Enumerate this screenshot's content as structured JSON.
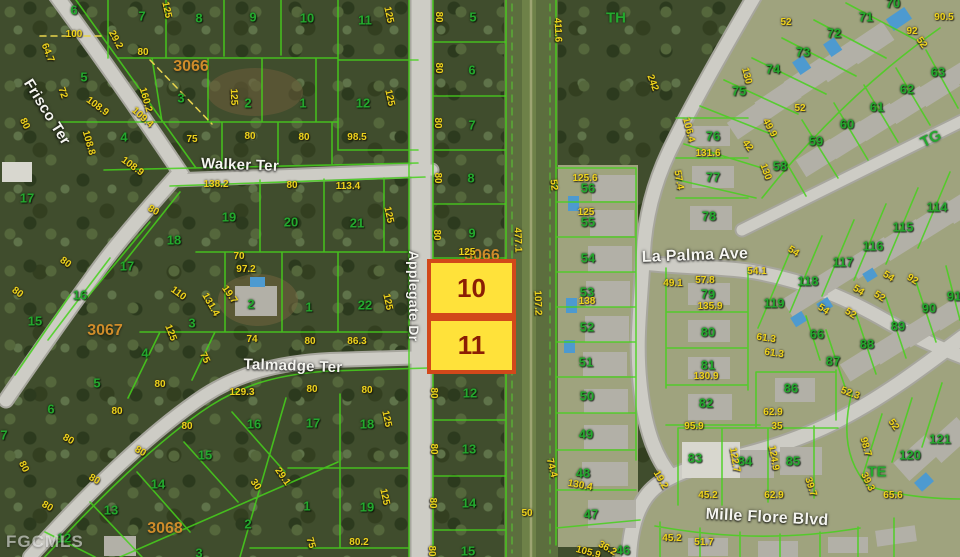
{
  "source_watermark": "FGCMLS",
  "colors": {
    "lot_text": "#24a82e",
    "dimension_text": "#eed31d",
    "block_text": "#cf8c2a",
    "street_text": "#f5f5f0",
    "parcel_line": "#47d11c",
    "highlight_fill": "#ffe23a",
    "highlight_border": "#d2481a",
    "highlight_text": "#8b1e04"
  },
  "highlight": {
    "lots": [
      {
        "label": "10"
      },
      {
        "label": "11"
      }
    ]
  },
  "map": {
    "street_labels": [
      {
        "t": "Frisco Ter",
        "x": 47,
        "y": 112,
        "r": 58,
        "s": 15
      },
      {
        "t": "Walker Ter",
        "x": 240,
        "y": 165,
        "r": 2,
        "s": 15
      },
      {
        "t": "Applegate Dr",
        "x": 414,
        "y": 296,
        "r": 90,
        "s": 14
      },
      {
        "t": "Talmadge Ter",
        "x": 293,
        "y": 366,
        "r": 2,
        "s": 15
      },
      {
        "t": "La Palma Ave",
        "x": 695,
        "y": 256,
        "r": -2,
        "s": 16
      },
      {
        "t": "Mille Flore Blvd",
        "x": 767,
        "y": 518,
        "r": 3,
        "s": 16
      }
    ],
    "block_labels": [
      {
        "t": "3066",
        "x": 191,
        "y": 67
      },
      {
        "t": "3066",
        "x": 482,
        "y": 256,
        "z": 3
      },
      {
        "t": "3067",
        "x": 105,
        "y": 331
      },
      {
        "t": "3068",
        "x": 165,
        "y": 529
      }
    ],
    "area_labels": [
      {
        "t": "TH",
        "x": 616,
        "y": 18
      },
      {
        "t": "TG",
        "x": 931,
        "y": 139,
        "r": -26
      },
      {
        "t": "TE",
        "x": 877,
        "y": 472
      }
    ],
    "lot_numbers": [
      {
        "t": "6",
        "x": 74,
        "y": 10
      },
      {
        "t": "7",
        "x": 142,
        "y": 16
      },
      {
        "t": "8",
        "x": 199,
        "y": 18
      },
      {
        "t": "9",
        "x": 253,
        "y": 17
      },
      {
        "t": "10",
        "x": 307,
        "y": 18
      },
      {
        "t": "11",
        "x": 365,
        "y": 20
      },
      {
        "t": "5",
        "x": 84,
        "y": 77
      },
      {
        "t": "3",
        "x": 181,
        "y": 98
      },
      {
        "t": "2",
        "x": 248,
        "y": 103
      },
      {
        "t": "1",
        "x": 303,
        "y": 103
      },
      {
        "t": "12",
        "x": 363,
        "y": 103
      },
      {
        "t": "4",
        "x": 124,
        "y": 137
      },
      {
        "t": "17",
        "x": 27,
        "y": 198
      },
      {
        "t": "5",
        "x": 473,
        "y": 17
      },
      {
        "t": "6",
        "x": 472,
        "y": 70
      },
      {
        "t": "7",
        "x": 472,
        "y": 125
      },
      {
        "t": "8",
        "x": 471,
        "y": 178
      },
      {
        "t": "9",
        "x": 472,
        "y": 233
      },
      {
        "t": "12",
        "x": 470,
        "y": 393
      },
      {
        "t": "13",
        "x": 469,
        "y": 449
      },
      {
        "t": "14",
        "x": 469,
        "y": 503
      },
      {
        "t": "15",
        "x": 468,
        "y": 551
      },
      {
        "t": "19",
        "x": 229,
        "y": 217
      },
      {
        "t": "20",
        "x": 291,
        "y": 222
      },
      {
        "t": "21",
        "x": 357,
        "y": 223
      },
      {
        "t": "18",
        "x": 174,
        "y": 240
      },
      {
        "t": "17",
        "x": 127,
        "y": 266
      },
      {
        "t": "16",
        "x": 80,
        "y": 295
      },
      {
        "t": "15",
        "x": 35,
        "y": 321
      },
      {
        "t": "2",
        "x": 251,
        "y": 304
      },
      {
        "t": "1",
        "x": 309,
        "y": 307
      },
      {
        "t": "22",
        "x": 365,
        "y": 305
      },
      {
        "t": "3",
        "x": 192,
        "y": 323
      },
      {
        "t": "4",
        "x": 145,
        "y": 353
      },
      {
        "t": "5",
        "x": 97,
        "y": 383
      },
      {
        "t": "6",
        "x": 51,
        "y": 409
      },
      {
        "t": "7",
        "x": 4,
        "y": 435
      },
      {
        "t": "17",
        "x": 313,
        "y": 423
      },
      {
        "t": "18",
        "x": 367,
        "y": 424
      },
      {
        "t": "16",
        "x": 254,
        "y": 424
      },
      {
        "t": "15",
        "x": 205,
        "y": 455
      },
      {
        "t": "14",
        "x": 158,
        "y": 484
      },
      {
        "t": "13",
        "x": 111,
        "y": 510
      },
      {
        "t": "12",
        "x": 64,
        "y": 538
      },
      {
        "t": "19",
        "x": 367,
        "y": 507
      },
      {
        "t": "1",
        "x": 307,
        "y": 506
      },
      {
        "t": "2",
        "x": 248,
        "y": 524
      },
      {
        "t": "3",
        "x": 199,
        "y": 553
      },
      {
        "t": "56",
        "x": 588,
        "y": 188
      },
      {
        "t": "55",
        "x": 588,
        "y": 222
      },
      {
        "t": "54",
        "x": 588,
        "y": 258
      },
      {
        "t": "53",
        "x": 587,
        "y": 292
      },
      {
        "t": "52",
        "x": 587,
        "y": 327
      },
      {
        "t": "51",
        "x": 586,
        "y": 362
      },
      {
        "t": "50",
        "x": 587,
        "y": 396
      },
      {
        "t": "49",
        "x": 586,
        "y": 434
      },
      {
        "t": "48",
        "x": 583,
        "y": 473
      },
      {
        "t": "47",
        "x": 591,
        "y": 514
      },
      {
        "t": "46",
        "x": 623,
        "y": 550
      },
      {
        "t": "70",
        "x": 893,
        "y": 3
      },
      {
        "t": "71",
        "x": 866,
        "y": 17
      },
      {
        "t": "72",
        "x": 834,
        "y": 33
      },
      {
        "t": "73",
        "x": 803,
        "y": 52
      },
      {
        "t": "74",
        "x": 773,
        "y": 69
      },
      {
        "t": "75",
        "x": 739,
        "y": 91
      },
      {
        "t": "76",
        "x": 713,
        "y": 136
      },
      {
        "t": "77",
        "x": 713,
        "y": 177
      },
      {
        "t": "78",
        "x": 709,
        "y": 216
      },
      {
        "t": "58",
        "x": 780,
        "y": 166
      },
      {
        "t": "59",
        "x": 816,
        "y": 141
      },
      {
        "t": "60",
        "x": 847,
        "y": 124
      },
      {
        "t": "61",
        "x": 877,
        "y": 107
      },
      {
        "t": "62",
        "x": 907,
        "y": 89
      },
      {
        "t": "63",
        "x": 938,
        "y": 72
      },
      {
        "t": "114",
        "x": 937,
        "y": 207
      },
      {
        "t": "115",
        "x": 903,
        "y": 227
      },
      {
        "t": "116",
        "x": 873,
        "y": 246
      },
      {
        "t": "117",
        "x": 843,
        "y": 262
      },
      {
        "t": "118",
        "x": 808,
        "y": 281
      },
      {
        "t": "119",
        "x": 774,
        "y": 303
      },
      {
        "t": "79",
        "x": 708,
        "y": 294
      },
      {
        "t": "80",
        "x": 708,
        "y": 332
      },
      {
        "t": "81",
        "x": 708,
        "y": 365
      },
      {
        "t": "66",
        "x": 817,
        "y": 334
      },
      {
        "t": "87",
        "x": 833,
        "y": 361
      },
      {
        "t": "88",
        "x": 867,
        "y": 344
      },
      {
        "t": "89",
        "x": 898,
        "y": 326
      },
      {
        "t": "90",
        "x": 929,
        "y": 308
      },
      {
        "t": "91",
        "x": 954,
        "y": 296
      },
      {
        "t": "86",
        "x": 791,
        "y": 388
      },
      {
        "t": "82",
        "x": 706,
        "y": 403
      },
      {
        "t": "83",
        "x": 695,
        "y": 458
      },
      {
        "t": "84",
        "x": 745,
        "y": 461
      },
      {
        "t": "85",
        "x": 793,
        "y": 461
      },
      {
        "t": "120",
        "x": 910,
        "y": 455
      },
      {
        "t": "121",
        "x": 940,
        "y": 439
      }
    ],
    "dimension_labels": [
      {
        "t": "100",
        "x": 74,
        "y": 35
      },
      {
        "t": "29.2",
        "x": 115,
        "y": 40,
        "r": 62
      },
      {
        "t": "80",
        "x": 143,
        "y": 53
      },
      {
        "t": "125",
        "x": 166,
        "y": 10,
        "r": 78
      },
      {
        "t": "64.7",
        "x": 47,
        "y": 53,
        "r": 68
      },
      {
        "t": "72",
        "x": 62,
        "y": 93,
        "r": 72
      },
      {
        "t": "108.9",
        "x": 97,
        "y": 107,
        "r": 36
      },
      {
        "t": "160.2",
        "x": 145,
        "y": 100,
        "r": 74
      },
      {
        "t": "109.4",
        "x": 142,
        "y": 118,
        "r": 42
      },
      {
        "t": "108.8",
        "x": 88,
        "y": 143,
        "r": 74
      },
      {
        "t": "108.9",
        "x": 132,
        "y": 167,
        "r": 36
      },
      {
        "t": "125",
        "x": 233,
        "y": 97,
        "r": 88
      },
      {
        "t": "75",
        "x": 192,
        "y": 140
      },
      {
        "t": "80",
        "x": 250,
        "y": 137
      },
      {
        "t": "80",
        "x": 304,
        "y": 138
      },
      {
        "t": "80",
        "x": 24,
        "y": 124,
        "r": 64
      },
      {
        "t": "138.2",
        "x": 216,
        "y": 185
      },
      {
        "t": "80",
        "x": 292,
        "y": 186
      },
      {
        "t": "113.4",
        "x": 348,
        "y": 187
      },
      {
        "t": "98.5",
        "x": 357,
        "y": 138
      },
      {
        "t": "125",
        "x": 388,
        "y": 15,
        "r": 78
      },
      {
        "t": "125",
        "x": 389,
        "y": 98,
        "r": 78
      },
      {
        "t": "80",
        "x": 438,
        "y": 17,
        "r": 90
      },
      {
        "t": "80",
        "x": 438,
        "y": 68,
        "r": 90
      },
      {
        "t": "80",
        "x": 437,
        "y": 123,
        "r": 90
      },
      {
        "t": "80",
        "x": 437,
        "y": 178,
        "r": 90
      },
      {
        "t": "80",
        "x": 436,
        "y": 235,
        "r": 90
      },
      {
        "t": "125",
        "x": 467,
        "y": 253
      },
      {
        "t": "477.1",
        "x": 517,
        "y": 240,
        "r": 88
      },
      {
        "t": "107.2",
        "x": 537,
        "y": 303,
        "r": 88
      },
      {
        "t": "411.6",
        "x": 557,
        "y": 30,
        "r": 88
      },
      {
        "t": "80",
        "x": 433,
        "y": 393,
        "r": 90
      },
      {
        "t": "80",
        "x": 433,
        "y": 449,
        "r": 90
      },
      {
        "t": "80",
        "x": 432,
        "y": 503,
        "r": 90
      },
      {
        "t": "80",
        "x": 431,
        "y": 551,
        "r": 90
      },
      {
        "t": "50",
        "x": 527,
        "y": 514
      },
      {
        "t": "125",
        "x": 388,
        "y": 215,
        "r": 78
      },
      {
        "t": "125",
        "x": 387,
        "y": 302,
        "r": 78
      },
      {
        "t": "70",
        "x": 239,
        "y": 257
      },
      {
        "t": "97.2",
        "x": 246,
        "y": 270
      },
      {
        "t": "19.7",
        "x": 229,
        "y": 295,
        "r": 55
      },
      {
        "t": "110",
        "x": 178,
        "y": 294,
        "r": 36
      },
      {
        "t": "131.4",
        "x": 210,
        "y": 305,
        "r": 60
      },
      {
        "t": "86.3",
        "x": 357,
        "y": 342
      },
      {
        "t": "80",
        "x": 310,
        "y": 342
      },
      {
        "t": "74",
        "x": 252,
        "y": 340
      },
      {
        "t": "125",
        "x": 170,
        "y": 333,
        "r": 68
      },
      {
        "t": "75",
        "x": 204,
        "y": 358,
        "r": 64
      },
      {
        "t": "80",
        "x": 153,
        "y": 211,
        "r": 30
      },
      {
        "t": "80",
        "x": 65,
        "y": 263,
        "r": 36
      },
      {
        "t": "80",
        "x": 17,
        "y": 293,
        "r": 36
      },
      {
        "t": "129.3",
        "x": 242,
        "y": 393
      },
      {
        "t": "80",
        "x": 160,
        "y": 385
      },
      {
        "t": "80",
        "x": 117,
        "y": 412
      },
      {
        "t": "80",
        "x": 68,
        "y": 440,
        "r": 30
      },
      {
        "t": "80",
        "x": 23,
        "y": 467,
        "r": 64
      },
      {
        "t": "80",
        "x": 47,
        "y": 507,
        "r": 30
      },
      {
        "t": "80",
        "x": 187,
        "y": 427
      },
      {
        "t": "80",
        "x": 140,
        "y": 452,
        "r": 30
      },
      {
        "t": "80",
        "x": 94,
        "y": 480,
        "r": 30
      },
      {
        "t": "29.1",
        "x": 282,
        "y": 477,
        "r": 55
      },
      {
        "t": "30",
        "x": 255,
        "y": 485,
        "r": 55
      },
      {
        "t": "75",
        "x": 310,
        "y": 543,
        "r": 74
      },
      {
        "t": "80.2",
        "x": 359,
        "y": 543
      },
      {
        "t": "125",
        "x": 386,
        "y": 419,
        "r": 78
      },
      {
        "t": "125",
        "x": 384,
        "y": 497,
        "r": 78
      },
      {
        "t": "80",
        "x": 312,
        "y": 390
      },
      {
        "t": "80",
        "x": 367,
        "y": 391
      },
      {
        "t": "242",
        "x": 652,
        "y": 83,
        "r": 70
      },
      {
        "t": "106.4",
        "x": 688,
        "y": 130,
        "r": 76
      },
      {
        "t": "52",
        "x": 786,
        "y": 23
      },
      {
        "t": "90.5",
        "x": 944,
        "y": 18
      },
      {
        "t": "92",
        "x": 912,
        "y": 32
      },
      {
        "t": "52",
        "x": 921,
        "y": 43,
        "r": 55
      },
      {
        "t": "52",
        "x": 800,
        "y": 109
      },
      {
        "t": "49.9",
        "x": 769,
        "y": 128,
        "r": 62
      },
      {
        "t": "42",
        "x": 747,
        "y": 146,
        "r": 55
      },
      {
        "t": "131.6",
        "x": 708,
        "y": 154
      },
      {
        "t": "130",
        "x": 765,
        "y": 172,
        "r": 70
      },
      {
        "t": "130",
        "x": 746,
        "y": 76,
        "r": 76
      },
      {
        "t": "57.4",
        "x": 678,
        "y": 180,
        "r": 80
      },
      {
        "t": "125.6",
        "x": 585,
        "y": 179
      },
      {
        "t": "52",
        "x": 553,
        "y": 185,
        "r": 84
      },
      {
        "t": "125",
        "x": 586,
        "y": 213
      },
      {
        "t": "138",
        "x": 587,
        "y": 302
      },
      {
        "t": "54.1",
        "x": 757,
        "y": 272
      },
      {
        "t": "57.8",
        "x": 705,
        "y": 281
      },
      {
        "t": "49.1",
        "x": 673,
        "y": 284
      },
      {
        "t": "135.9",
        "x": 710,
        "y": 307
      },
      {
        "t": "61.3",
        "x": 766,
        "y": 339,
        "r": 8
      },
      {
        "t": "61.3",
        "x": 774,
        "y": 354,
        "r": 8
      },
      {
        "t": "54",
        "x": 793,
        "y": 252,
        "r": 32
      },
      {
        "t": "54",
        "x": 858,
        "y": 291,
        "r": 32
      },
      {
        "t": "54",
        "x": 823,
        "y": 310,
        "r": 32
      },
      {
        "t": "54",
        "x": 888,
        "y": 277,
        "r": 32
      },
      {
        "t": "52",
        "x": 879,
        "y": 297,
        "r": 32
      },
      {
        "t": "52",
        "x": 850,
        "y": 314,
        "r": 32
      },
      {
        "t": "92",
        "x": 912,
        "y": 280,
        "r": 32
      },
      {
        "t": "130.9",
        "x": 706,
        "y": 377
      },
      {
        "t": "95.9",
        "x": 694,
        "y": 427
      },
      {
        "t": "122.7",
        "x": 734,
        "y": 460,
        "r": 80
      },
      {
        "t": "124.9",
        "x": 773,
        "y": 458,
        "r": 80
      },
      {
        "t": "62.9",
        "x": 773,
        "y": 413
      },
      {
        "t": "35",
        "x": 777,
        "y": 427
      },
      {
        "t": "62.9",
        "x": 774,
        "y": 496
      },
      {
        "t": "39.7",
        "x": 810,
        "y": 487,
        "r": 72
      },
      {
        "t": "45.2",
        "x": 708,
        "y": 496
      },
      {
        "t": "19.2",
        "x": 660,
        "y": 480,
        "r": 60
      },
      {
        "t": "45.2",
        "x": 672,
        "y": 539
      },
      {
        "t": "51.7",
        "x": 704,
        "y": 543
      },
      {
        "t": "52",
        "x": 893,
        "y": 425,
        "r": 55
      },
      {
        "t": "98.7",
        "x": 865,
        "y": 447,
        "r": 74
      },
      {
        "t": "39.3",
        "x": 867,
        "y": 482,
        "r": 64
      },
      {
        "t": "65.6",
        "x": 893,
        "y": 496
      },
      {
        "t": "52.3",
        "x": 850,
        "y": 394,
        "r": 20
      },
      {
        "t": "74.4",
        "x": 551,
        "y": 468,
        "r": 76
      },
      {
        "t": "130.4",
        "x": 580,
        "y": 486,
        "r": 10
      },
      {
        "t": "105.9",
        "x": 588,
        "y": 553,
        "r": 15
      },
      {
        "t": "36.2",
        "x": 607,
        "y": 549,
        "r": 30
      }
    ]
  }
}
